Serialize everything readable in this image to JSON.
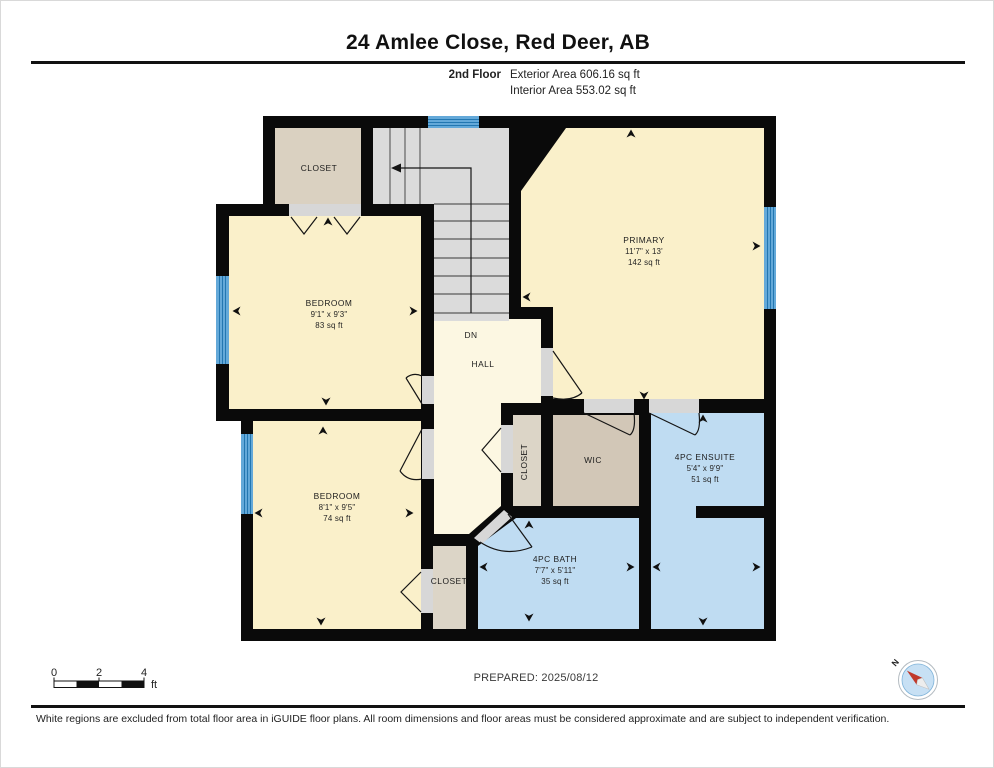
{
  "header": {
    "title": "24 Amlee Close, Red Deer, AB",
    "floor_label": "2nd Floor",
    "exterior_area": "Exterior Area 606.16 sq ft",
    "interior_area": "Interior Area 553.02 sq ft"
  },
  "plan": {
    "rooms": [
      {
        "id": "closet-top-left",
        "name": "CLOSET",
        "cx": 318,
        "cy": 170
      },
      {
        "id": "bedroom-upper",
        "name": "BEDROOM",
        "dims": "9'1\" x 9'3\"",
        "area": "83 sq ft",
        "cx": 328,
        "cy": 305
      },
      {
        "id": "primary",
        "name": "PRIMARY",
        "dims": "11'7\" x 13'",
        "area": "142 sq ft",
        "cx": 643,
        "cy": 242
      },
      {
        "id": "stairs-direction",
        "name": "DN",
        "cx": 470,
        "cy": 337
      },
      {
        "id": "hall",
        "name": "HALL",
        "cx": 482,
        "cy": 366
      },
      {
        "id": "bedroom-lower",
        "name": "BEDROOM",
        "dims": "8'1\" x 9'5\"",
        "area": "74 sq ft",
        "cx": 336,
        "cy": 498
      },
      {
        "id": "closet-hall",
        "name": "CLOSET",
        "cx": 526,
        "cy": 461,
        "rotate": -90
      },
      {
        "id": "wic",
        "name": "WIC",
        "cx": 592,
        "cy": 462
      },
      {
        "id": "ensuite",
        "name": "4PC ENSUITE",
        "dims": "5'4\" x 9'9\"",
        "area": "51 sq ft",
        "cx": 704,
        "cy": 459
      },
      {
        "id": "bath",
        "name": "4PC BATH",
        "dims": "7'7\" x 5'11\"",
        "area": "35 sq ft",
        "cx": 554,
        "cy": 561
      },
      {
        "id": "closet-lower",
        "name": "CLOSET",
        "cx": 448,
        "cy": 583
      }
    ],
    "markers": [
      [
        327,
        221,
        "up"
      ],
      [
        236,
        310,
        "left"
      ],
      [
        412,
        310,
        "right"
      ],
      [
        325,
        400,
        "down"
      ],
      [
        322,
        430,
        "up"
      ],
      [
        258,
        512,
        "left"
      ],
      [
        408,
        512,
        "right"
      ],
      [
        320,
        620,
        "down"
      ],
      [
        630,
        133,
        "up"
      ],
      [
        526,
        296,
        "left"
      ],
      [
        755,
        245,
        "right"
      ],
      [
        643,
        394,
        "down"
      ],
      [
        702,
        418,
        "up"
      ],
      [
        656,
        566,
        "left"
      ],
      [
        755,
        566,
        "right"
      ],
      [
        702,
        620,
        "down"
      ],
      [
        483,
        566,
        "left"
      ],
      [
        629,
        566,
        "right"
      ],
      [
        528,
        524,
        "up"
      ],
      [
        528,
        616,
        "down"
      ]
    ],
    "colors": {
      "wall": "#0A0A0A",
      "room_cream": "#FAF0CA",
      "hall_cream": "#FCF7E2",
      "closet_tan": "#DAD1C1",
      "closet_tan2": "#DCD5C7",
      "wic_tan": "#D2C7B7",
      "stairs_gray": "#DBDBDB",
      "opening_gray": "#D7D7D7",
      "wet_blue": "#BFDCF2",
      "window_blue": "#64A9D9",
      "window_stripe": "#2377B1",
      "needle_red": "#C0392B"
    }
  },
  "scale_bar": {
    "ticks": [
      "0",
      "2",
      "4"
    ],
    "unit": "ft"
  },
  "prepared_label": "PREPARED: 2025/08/12",
  "compass": {
    "north_label": "N"
  },
  "disclaimer": "White regions are excluded from total floor area in iGUIDE floor plans. All room dimensions and floor areas must be considered approximate and are subject to independent verification."
}
